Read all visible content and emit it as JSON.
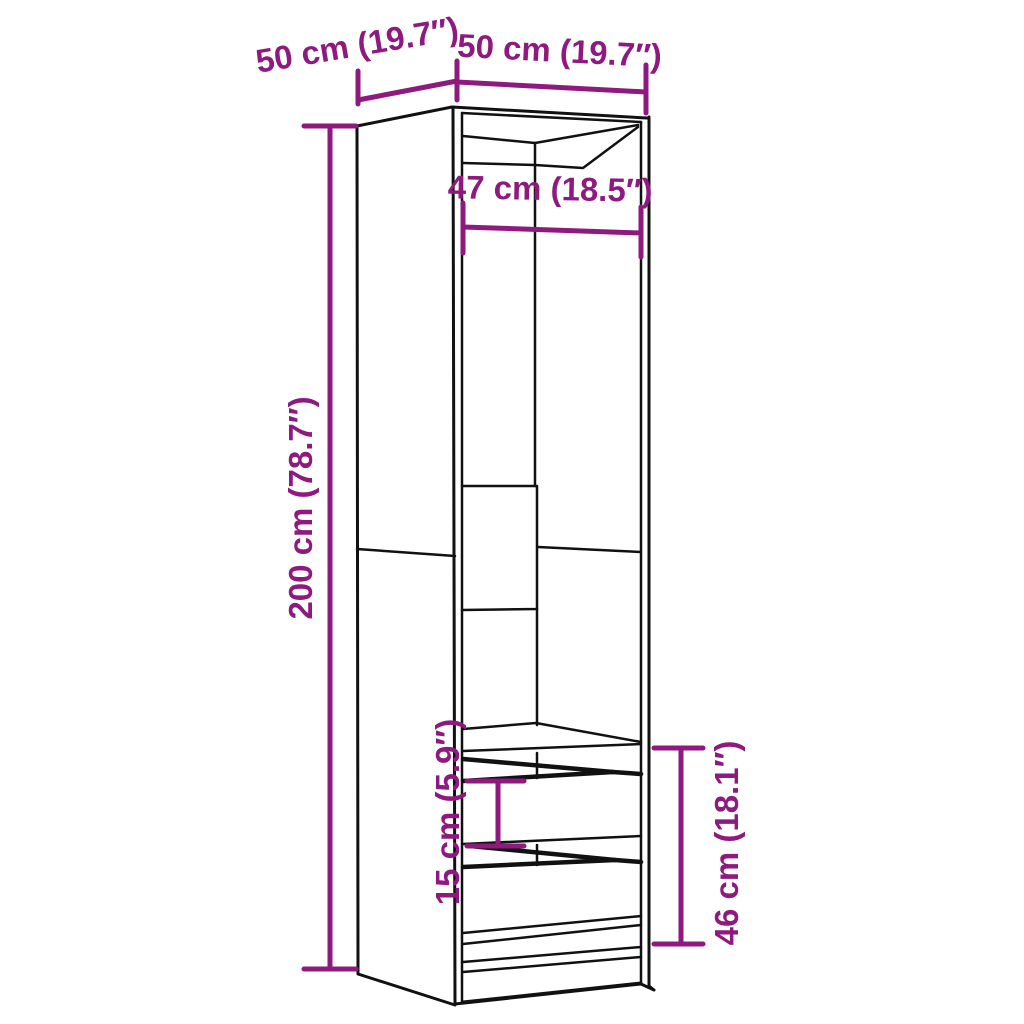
{
  "diagram": {
    "kind": "furniture dimension diagram",
    "subject": "tall open wardrobe with two drawers",
    "colors": {
      "accent": "#8e1a7f",
      "outline": "#111111",
      "background": "#ffffff"
    },
    "dimensions": {
      "depth_top_left": "50 cm (19.7″)",
      "width_top_right": "50 cm (19.7″)",
      "inner_width": "47 cm (18.5″)",
      "height": "200 cm (78.7″)",
      "drawer_front_height": "15 cm (5.9″)",
      "drawer_section_height": "46 cm (18.1″)"
    }
  }
}
